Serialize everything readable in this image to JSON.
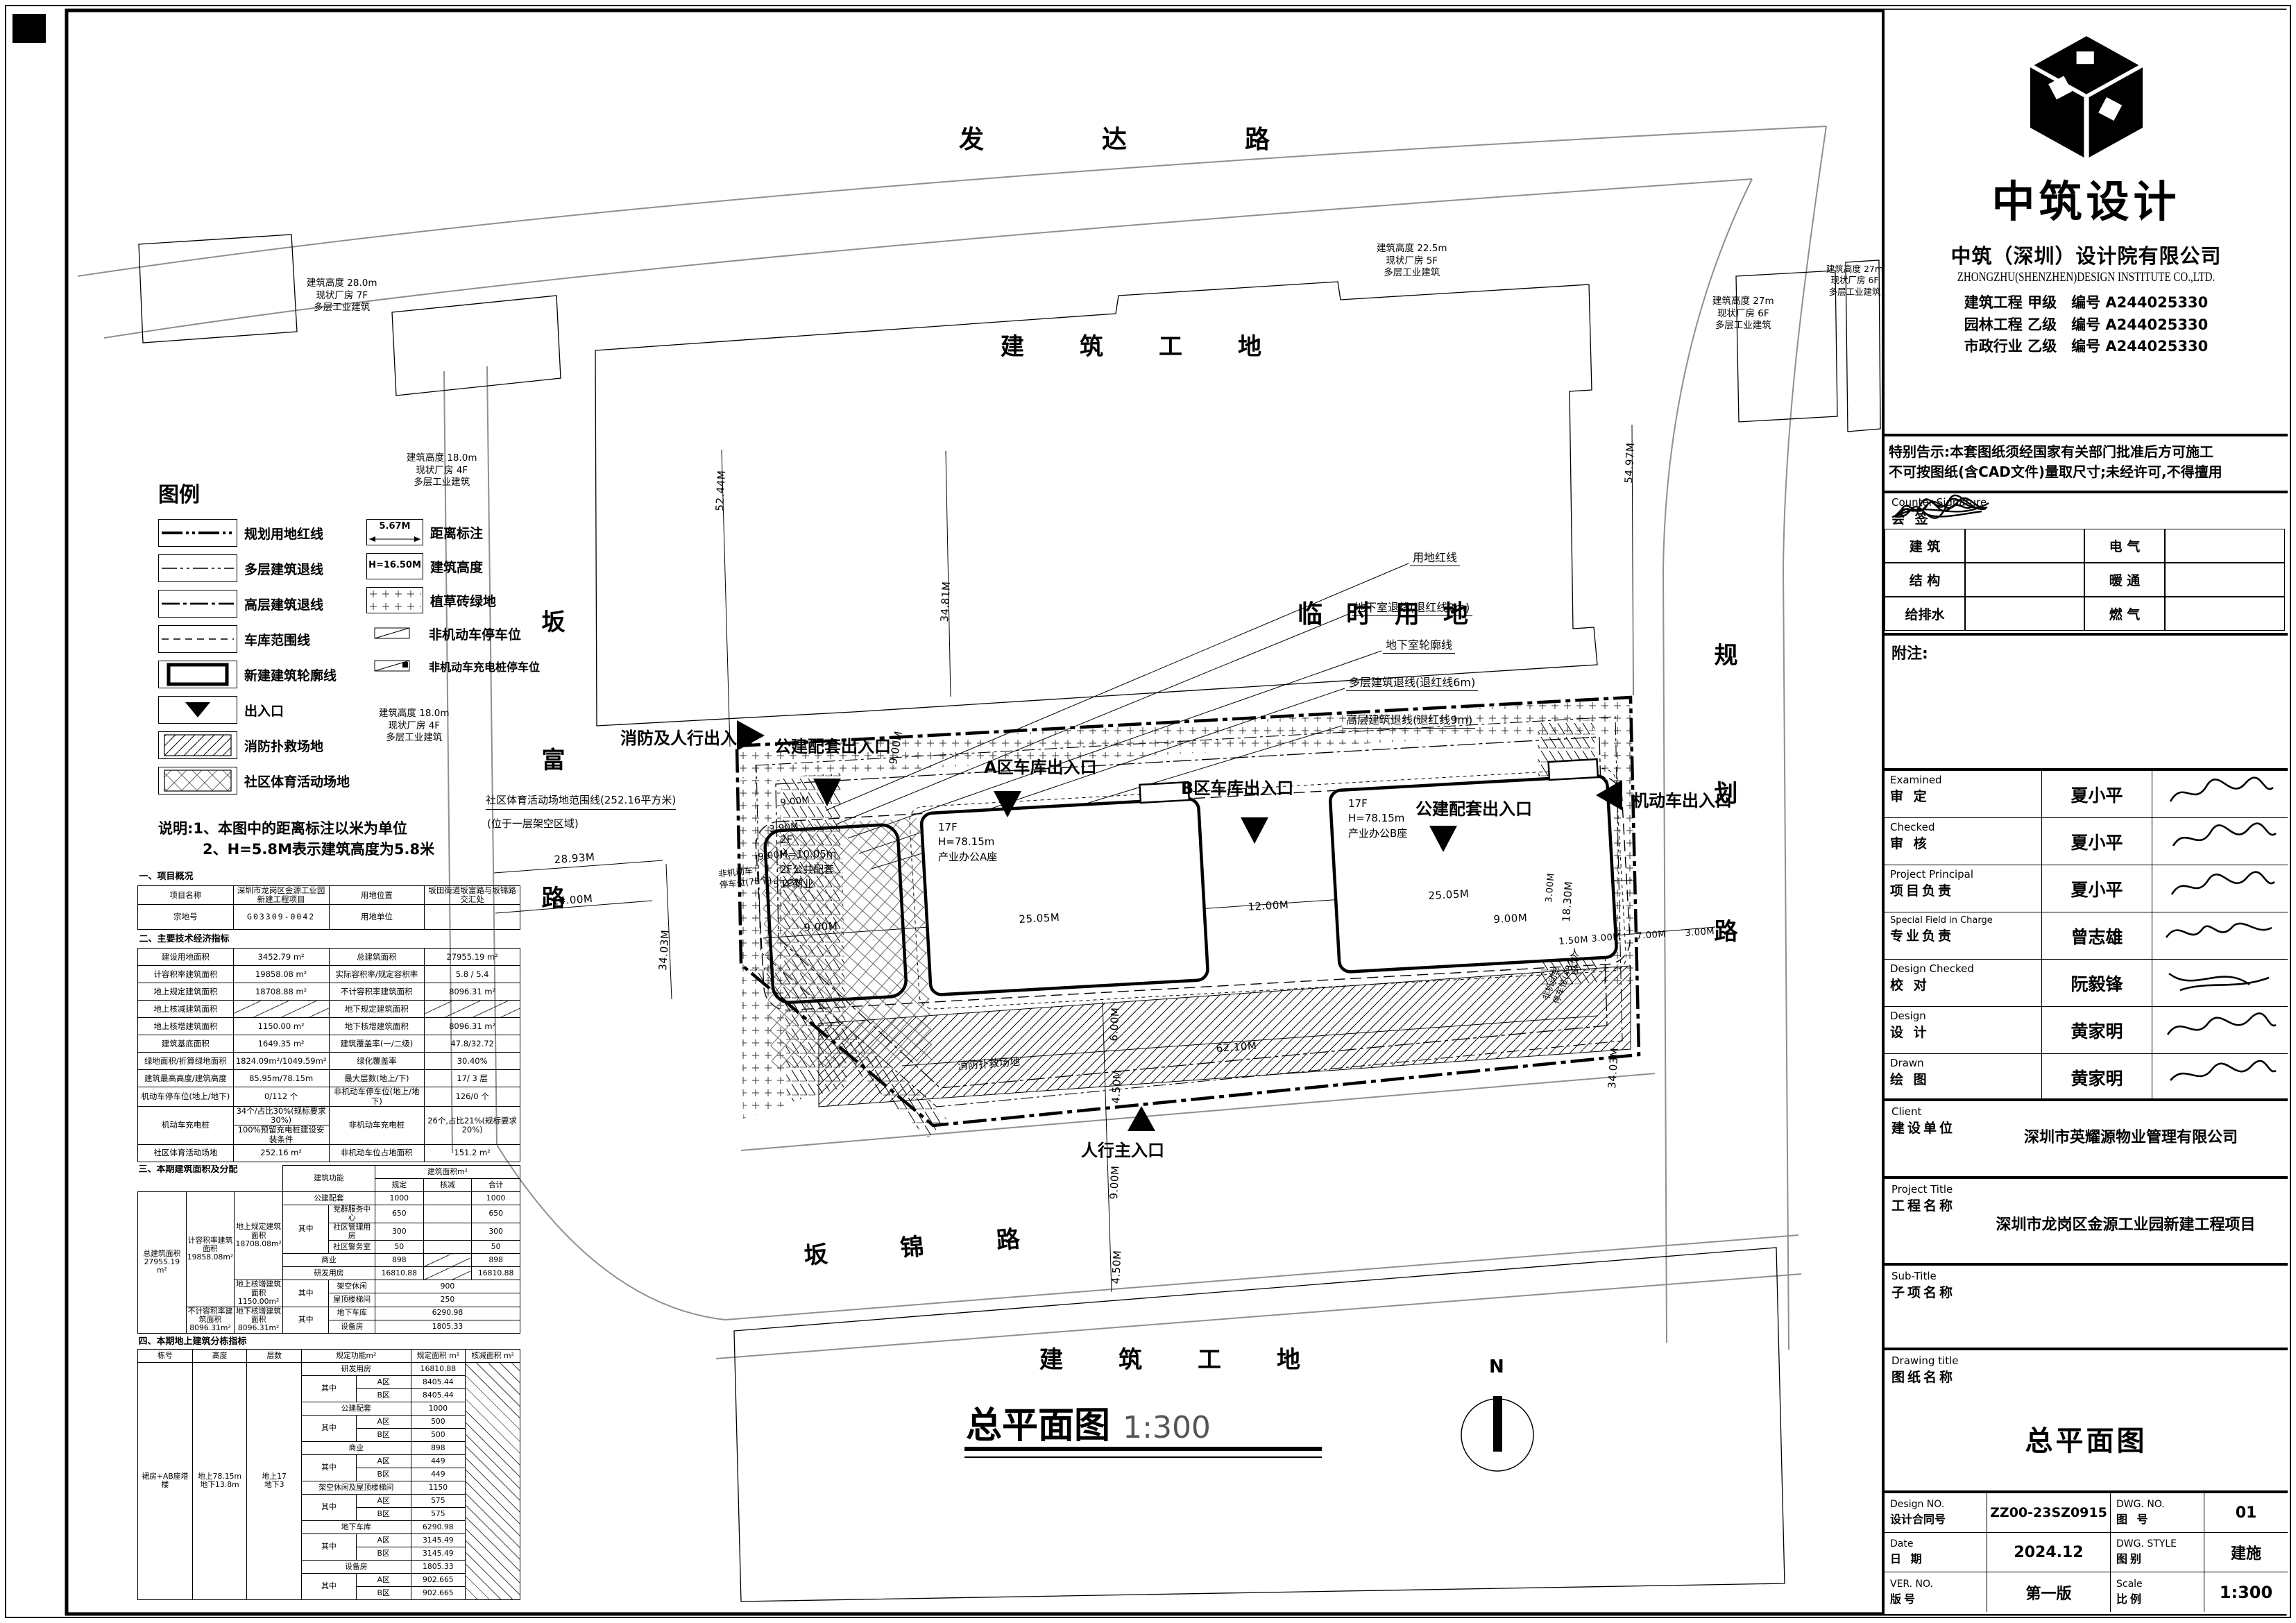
{
  "plan": {
    "roads": {
      "top": "发达路",
      "left": "坂富路",
      "right": "规划路",
      "bottom": "坂锦路"
    },
    "areas": {
      "site_top": "建筑工地",
      "temp": "临时用地",
      "site_bottom": "建筑工地",
      "fire": "消防扑救场地"
    },
    "entrances": [
      "消防及人行出入口",
      "公建配套出入口",
      "A区车库出入口",
      "B区车库出入口",
      "公建配套出入口",
      "机动车出入口",
      "人行主入口"
    ],
    "callouts": [
      "用地红线",
      "地下室退线(退红线3m)",
      "地下室轮廓线",
      "多层建筑退线(退红线6m)",
      "高层建筑退线(退红线9m)"
    ],
    "buildings": [
      "2F\nH=10.05m\n2F公共配套\n1F商业",
      "17F\nH=78.15m\n产业办公A座",
      "17F\nH=78.15m\n产业办公B座"
    ],
    "site_note1": "社区体育活动场地范围线(252.16平方米)",
    "site_note2": "(位于一层架空区域)",
    "annotations": [
      "建筑高度 28.0m\n现状厂房 7F\n多层工业建筑",
      "建筑高度 18.0m\n现状厂房 4F\n多层工业建筑",
      "建筑高度 18.0m\n现状厂房 4F\n多层工业建筑",
      "建筑高度 22.5m\n现状厂房 5F\n多层工业建筑",
      "建筑高度 27m\n现状厂房 6F\n多层工业建筑",
      "建筑高度 27m\n现状厂房 6F\n多层工业建筑"
    ],
    "notes": {
      "parking_left": "非机动车\n停车位(78个)",
      "parking_right": "非机动车\n停车位(48个)",
      "sidewalk": "人行道"
    },
    "dims": [
      "52.44M",
      "34.81M",
      "54.97M",
      "28.93M",
      "14.00M",
      "34.03M",
      "9.00M",
      "25.05M",
      "12.00M",
      "25.05M",
      "18.30M",
      "9.00M",
      "62.10M",
      "6.00M",
      "4.50M",
      "9.00M",
      "4.50M",
      "9.00M",
      "1.50M",
      "3.00M",
      "7.00M",
      "3.00M",
      "34.03M",
      "9.00M",
      "3.90M",
      "9.00M",
      "5.23M",
      "3.00M"
    ],
    "title": "总平面图",
    "scale": "1:300",
    "north": "N"
  },
  "legend": {
    "title": "图例",
    "left": [
      "规划用地红线",
      "多层建筑退线",
      "高层建筑退线",
      "车库范围线",
      "新建建筑轮廓线",
      "出入口",
      "消防扑救场地",
      "社区体育活动场地"
    ],
    "right": [
      "距离标注",
      "建筑高度",
      "植草砖绿地",
      "非机动车停车位",
      "非机动车充电桩停车位"
    ],
    "sym_dist": "5.67M",
    "sym_h": "H=16.50M",
    "notes1": "说明:1、本图中的距离标注以米为单位",
    "notes2": "2、H=5.8M表示建筑高度为5.8米"
  },
  "tables": {
    "t1_title": "一、项目概况",
    "t1r0": [
      "项目名称",
      "深圳市龙岗区金源工业园新建工程项目",
      "用地位置",
      "坂田街道坂富路与坂锦路交汇处"
    ],
    "t1r1": [
      "宗地号",
      "G03309-0042",
      "用地单位",
      ""
    ],
    "t2_title": "二、主要技术经济指标",
    "t2": [
      [
        "建设用地面积",
        "3452.79 m²",
        "总建筑面积",
        "27955.19 m²"
      ],
      [
        "计容积率建筑面积",
        "19858.08 m²",
        "实际容积率/规定容积率",
        "5.8 / 5.4"
      ],
      [
        "地上规定建筑面积",
        "18708.88 m²",
        "不计容积率建筑面积",
        "8096.31 m²"
      ],
      [
        "地上核减建筑面积",
        "",
        "地下规定建筑面积",
        ""
      ],
      [
        "地上核增建筑面积",
        "1150.00 m²",
        "地下核增建筑面积",
        "8096.31 m²"
      ],
      [
        "建筑基底面积",
        "1649.35 m²",
        "建筑覆盖率(一/二级)",
        "47.8/32.72"
      ],
      [
        "绿地面积/折算绿地面积",
        "1824.09m²/1049.59m²",
        "绿化覆盖率",
        "30.40%"
      ],
      [
        "建筑最高高度/建筑高度",
        "85.95m/78.15m",
        "最大层数(地上/下)",
        "17/ 3 层"
      ],
      [
        "机动车停车位(地上/地下)",
        "0/112 个",
        "非机动车停车位(地上/地下)",
        "126/0 个"
      ],
      [
        "社区体育活动场地",
        "252.16 m²",
        "非机动车位占地面积",
        "151.2 m²"
      ]
    ],
    "t2cd": {
      "a": "机动车充电桩",
      "b": "34个/占比30%(规标要求30%)",
      "c": "100%预留充电桩建设安装条件",
      "d": "非机动车充电桩",
      "e": "26个,占比21%(规标要求20%)"
    },
    "t3_title": "三、本期建筑面积及分配",
    "t3": {
      "h_func": "建筑功能",
      "h_area": "建筑面积m²",
      "h_gd": "规定",
      "h_hj": "核减",
      "h_total": "合计",
      "qz": "其中",
      "total": "总建筑面积\n27955.19 m²",
      "jr": "计容积率建筑面积\n19858.08m²",
      "bjr": "不计容积率建筑面积\n8096.31m²",
      "dsgd": "地上规定建筑面积\n18708.08m²",
      "dshz": "地上核增建筑面积\n1150.00m²",
      "dxhz": "地下核增建筑面积\n8096.31m²",
      "gj": [
        "公建配套",
        "1000",
        "1000"
      ],
      "dq": [
        "党群服务中心",
        "650",
        "650"
      ],
      "sq": [
        "社区管理用房",
        "300",
        "300"
      ],
      "jw": [
        "社区警务室",
        "50",
        "50"
      ],
      "sy": [
        "商业",
        "898",
        "898"
      ],
      "yf": [
        "研发用房",
        "16810.88",
        "16810.88"
      ],
      "jk": [
        "架空休闲",
        "900"
      ],
      "wd": [
        "屋顶楼梯间",
        "250"
      ],
      "dc": [
        "地下车库",
        "6290.98"
      ],
      "sb": [
        "设备房",
        "1805.33"
      ]
    },
    "t4_title": "四、本期地上建筑分栋指标",
    "t4": {
      "h": [
        "栋号",
        "高度",
        "层数",
        "规定功能m²",
        "规定面积 m²",
        "核减面积 m²"
      ],
      "dong": "裙房+AB座塔楼",
      "height": "地上78.15m\n地下13.8m",
      "floors": "地上17\n地下3",
      "qz": "其中",
      "rows": [
        [
          "研发用房",
          "16810.88"
        ],
        [
          "A区",
          "8405.44"
        ],
        [
          "B区",
          "8405.44"
        ],
        [
          "公建配套",
          "1000"
        ],
        [
          "A区",
          "500"
        ],
        [
          "B区",
          "500"
        ],
        [
          "商业",
          "898"
        ],
        [
          "A区",
          "449"
        ],
        [
          "B区",
          "449"
        ],
        [
          "架空休闲及屋顶楼梯间",
          "1150"
        ],
        [
          "A区",
          "575"
        ],
        [
          "B区",
          "575"
        ],
        [
          "地下车库",
          "6290.98"
        ],
        [
          "A区",
          "3145.49"
        ],
        [
          "B区",
          "3145.49"
        ],
        [
          "设备房",
          "1805.33"
        ],
        [
          "A区",
          "902.665"
        ],
        [
          "B区",
          "902.665"
        ]
      ]
    }
  },
  "tb": {
    "brand": "中筑设计",
    "company_cn": "中筑（深圳）设计院有限公司",
    "company_en": "ZHONGZHU(SHENZHEN)DESIGN INSTITUTE CO.,LTD.",
    "certs": [
      "建筑工程 甲级　编号 A244025330",
      "园林工程 乙级　编号 A244025330",
      "市政行业 乙级　编号 A244025330"
    ],
    "notice": "特别告示:本套图纸须经国家有关部门批准后方可施工\n不可按图纸(含CAD文件)量取尺寸;未经许可,不得擅用",
    "cs_en": "Counter Signature",
    "cs_cn": "会  签",
    "cs_labels": [
      "建 筑",
      "电 气",
      "结 构",
      "暖 通",
      "给排水",
      "燃 气"
    ],
    "note_label": "附注:",
    "personnel": [
      {
        "en": "Examined",
        "cn": "审 定",
        "name": "夏小平"
      },
      {
        "en": "Checked",
        "cn": "审 核",
        "name": "夏小平"
      },
      {
        "en": "Project Principal",
        "cn": "项目负责",
        "name": "夏小平"
      },
      {
        "en": "Special Field in Charge",
        "cn": "专业负责",
        "name": "曾志雄"
      },
      {
        "en": "Design Checked",
        "cn": "校 对",
        "name": "阮毅锋"
      },
      {
        "en": "Design",
        "cn": "设 计",
        "name": "黄家明"
      },
      {
        "en": "Drawn",
        "cn": "绘 图",
        "name": "黄家明"
      }
    ],
    "client_en": "Client",
    "client_cn": "建设单位",
    "client": "深圳市英耀源物业管理有限公司",
    "project_en": "Project Title",
    "project_cn": "工程名称",
    "project": "深圳市龙岗区金源工业园新建工程项目",
    "sub_en": "Sub-Title",
    "sub_cn": "子项名称",
    "sub": "",
    "dwg_en": "Drawing title",
    "dwg_cn": "图纸名称",
    "dwg": "总平面图",
    "grid": [
      {
        "en": "Design NO.",
        "cn": "设计合同号",
        "v": "ZZ00-23SZ0915"
      },
      {
        "en": "DWG. NO.",
        "cn": "图 号",
        "v": "01"
      },
      {
        "en": "Date",
        "cn": "日 期",
        "v": "2024.12"
      },
      {
        "en": "DWG. STYLE",
        "cn": "图别",
        "v": "建施"
      },
      {
        "en": "VER. NO.",
        "cn": "版号",
        "v": "第一版"
      },
      {
        "en": "Scale",
        "cn": "比例",
        "v": "1:300"
      }
    ]
  }
}
